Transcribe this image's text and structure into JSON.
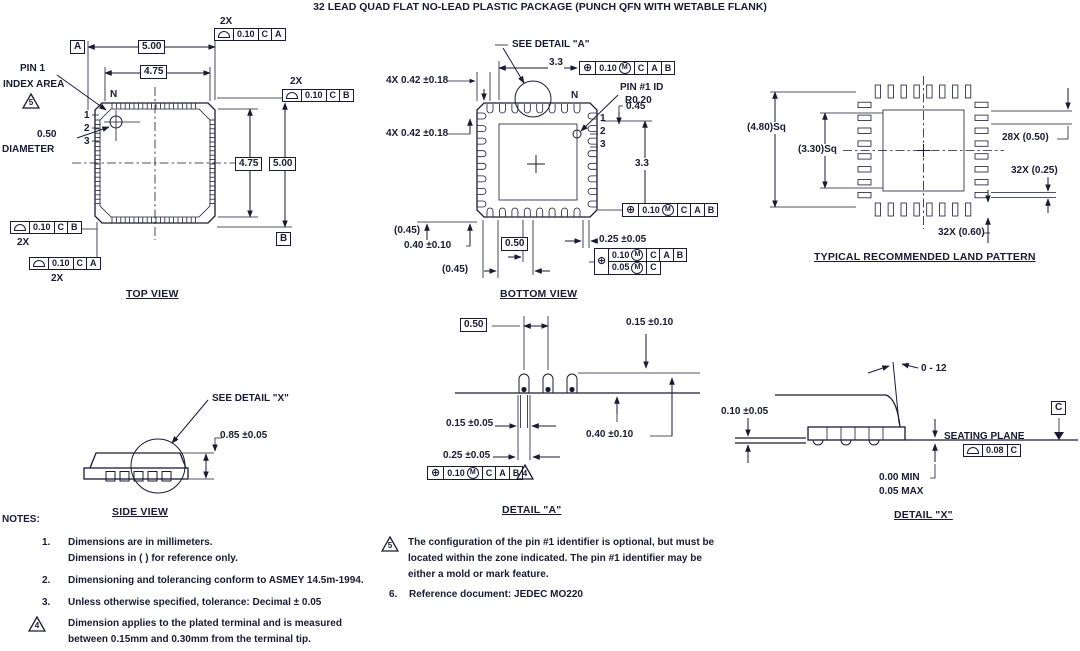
{
  "title": "32 LEAD QUAD FLAT NO-LEAD PLASTIC PACKAGE (PUNCH QFN WITH WETABLE FLANK)",
  "top_view": {
    "label": "TOP VIEW",
    "qty_top": "2X",
    "fcf_top": {
      "tol": "0.10",
      "d1": "C",
      "d2": "A"
    },
    "qty_right": "2X",
    "fcf_right": {
      "tol": "0.10",
      "d1": "C",
      "d2": "B"
    },
    "qty_left": "2X",
    "fcf_left": {
      "tol": "0.10",
      "d1": "C",
      "d2": "B"
    },
    "qty_bottom": "2X",
    "fcf_bottom": {
      "tol": "0.10",
      "d1": "C",
      "d2": "A"
    },
    "datum_a": "A",
    "datum_b": "B",
    "dim_width_outer": "5.00",
    "dim_width_inner": "4.75",
    "dim_height_inner": "4.75",
    "dim_height_outer": "5.00",
    "pin1_callout": [
      "PIN 1",
      "INDEX AREA"
    ],
    "pin1_flag": "5",
    "n_label": "N",
    "pin_numbers": [
      "1",
      "2",
      "3"
    ],
    "diameter": [
      "0.50",
      "DIAMETER"
    ]
  },
  "bottom_view": {
    "label": "BOTTOM VIEW",
    "see_detail": "SEE DETAIL \"A\"",
    "dim_top": "3.3",
    "fcf_top": {
      "tol": "0.10",
      "mod": "M",
      "d1": "C",
      "d2": "A",
      "d3": "B"
    },
    "dim_corner_top": "4X 0.42 ±0.18",
    "dim_corner_left": "4X 0.42 ±0.18",
    "pin1_id": [
      "PIN #1 ID",
      "R0.20"
    ],
    "n_label": "N",
    "dim_045": "0.45",
    "pin_numbers": [
      "1",
      "2",
      "3"
    ],
    "dim_right": "3.3",
    "fcf_right": {
      "tol": "0.10",
      "mod": "M",
      "d1": "C",
      "d2": "A",
      "d3": "B"
    },
    "ref_left": "(0.45)",
    "dim_lead_len": "0.40 ±0.10",
    "pitch": "0.50",
    "dim_lead_width": "0.25 ±0.05",
    "fcf_stack": {
      "tol1": "0.10",
      "mod1": "M",
      "d1": "C",
      "d2": "A",
      "d3": "B",
      "tol2": "0.05",
      "mod2": "M",
      "d4": "C"
    },
    "ref_bottom": "(0.45)"
  },
  "land_pattern": {
    "label": "TYPICAL RECOMMENDED LAND PATTERN",
    "ref_outer": "(4.80)Sq",
    "ref_inner": "(3.30)Sq",
    "dim_pitch": "28X (0.50)",
    "dim_width": "32X (0.25)",
    "dim_length": "32X (0.60)"
  },
  "side_view": {
    "label": "SIDE VIEW",
    "see_detail": "SEE DETAIL \"X\"",
    "dim_height": "0.85 ±0.05"
  },
  "detail_a": {
    "label": "DETAIL \"A\"",
    "pitch": "0.50",
    "dim_standoff": "0.15 ±0.10",
    "dim_inner": "0.15 ±0.05",
    "dim_lead": "0.40 ±0.10",
    "dim_outer": "0.25 ±0.05",
    "fcf": {
      "tol": "0.10",
      "mod": "M",
      "d1": "C",
      "d2": "A",
      "d3": "B"
    },
    "flag": "4"
  },
  "detail_x": {
    "label": "DETAIL \"X\"",
    "angle": "0 - 12",
    "dim_standoff": "0.10 ±0.05",
    "datum_c": "C",
    "seating_plane": "SEATING PLANE",
    "fcf": {
      "tol": "0.08",
      "d1": "C"
    },
    "min": "0.00 MIN",
    "max": "0.05 MAX"
  },
  "notes": {
    "header": "NOTES:",
    "n1_num": "1.",
    "n1_lines": [
      "Dimensions are in millimeters.",
      "Dimensions in (  ) for reference only."
    ],
    "n2_num": "2.",
    "n2_line": "Dimensioning and tolerancing conform to ASMEY 14.5m-1994.",
    "n3_num": "3.",
    "n3_line": "Unless otherwise specified, tolerance: Decimal ± 0.05",
    "n4_flag": "4",
    "n4_lines": [
      "Dimension applies to the plated terminal and is measured",
      "between 0.15mm and 0.30mm from the terminal tip."
    ],
    "n5_flag": "5",
    "n5_lines": [
      "The configuration of the pin #1 identifier is optional, but must be",
      "located within the zone indicated. The pin #1 identifier may be",
      "either a mold or mark feature."
    ],
    "n6_num": "6.",
    "n6_line": "Reference document: JEDEC MO220"
  }
}
